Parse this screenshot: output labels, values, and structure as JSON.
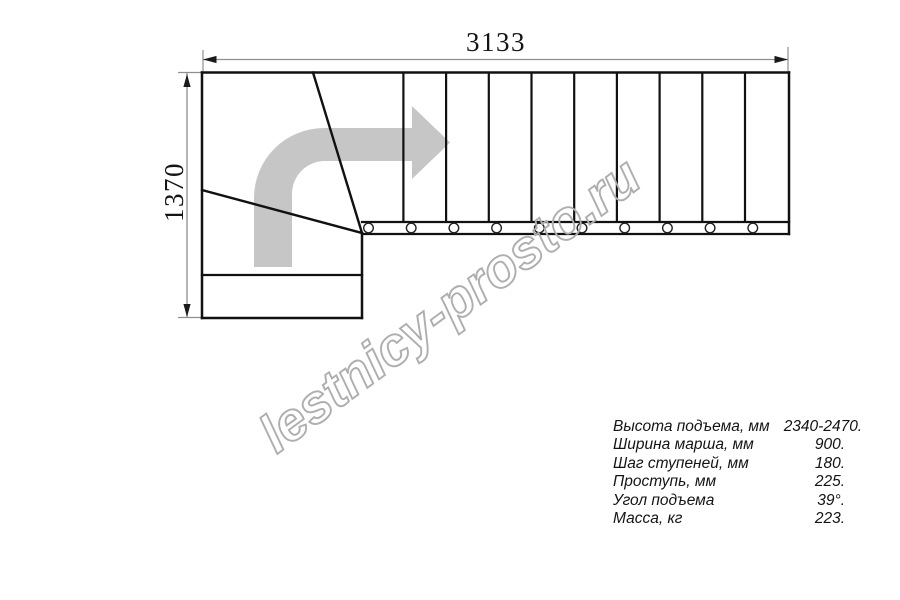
{
  "dimensions": {
    "width_label": "3133",
    "height_label": "1370"
  },
  "watermark": {
    "text": "lestnicy-prosto.ru"
  },
  "specs": {
    "rows": [
      {
        "label": "Высота подъема, мм",
        "value": "2340-2470."
      },
      {
        "label": "Ширина марша, мм",
        "value": "900."
      },
      {
        "label": "Шаг ступеней, мм",
        "value": "180."
      },
      {
        "label": "Проступь, мм",
        "value": "225."
      },
      {
        "label": "Угол подъема",
        "value": "39°."
      },
      {
        "label": "Масса, кг",
        "value": "223."
      }
    ]
  },
  "colors": {
    "line": "#111111",
    "dimension_line": "#8f8f8f",
    "arrow_fill": "#c6c6c6",
    "watermark_outline": "#aeaeae"
  }
}
